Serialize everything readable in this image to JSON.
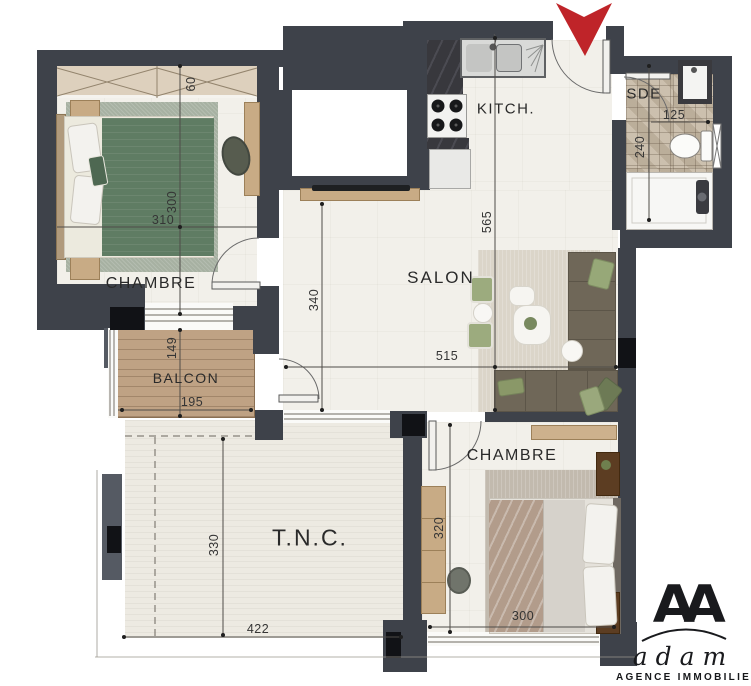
{
  "plan": {
    "rooms": {
      "chambre1": {
        "label": "CHAMBRE"
      },
      "kitchen": {
        "label": "KITCH."
      },
      "sde": {
        "label": "SDE"
      },
      "salon": {
        "label": "SALON"
      },
      "balcon": {
        "label": "BALCON"
      },
      "tnc": {
        "label": "T.N.C."
      },
      "chambre2": {
        "label": "CHAMBRE"
      }
    },
    "dimensions_cm": {
      "chambre1_closet_depth": "60",
      "chambre1_width": "310",
      "chambre1_depth": "300",
      "salon_left_height": "340",
      "kitchen_salon_height": "565",
      "salon_width": "515",
      "balcon_depth": "149",
      "balcon_width": "195",
      "sde_width": "125",
      "sde_depth": "240",
      "tnc_depth": "330",
      "tnc_width": "422",
      "chambre2_depth": "320",
      "chambre2_width": "300"
    },
    "entrance": {
      "direction": "down",
      "arrow_color": "#bf2429"
    },
    "colors": {
      "wall": "#3e424a",
      "accent_block": "#111216",
      "floor": "#f2f0ea",
      "balcony_wood": "#bfa284",
      "bathroom_tile": "#c6b9a5",
      "bed_green": "#5f7c63",
      "sofa": "#6f6758",
      "rug_green": "#a7b1a2",
      "arrow_red": "#bf2429"
    },
    "logo": {
      "monogram": "AA",
      "name": "adam",
      "tagline": "AGENCE IMMOBILIERE"
    }
  }
}
